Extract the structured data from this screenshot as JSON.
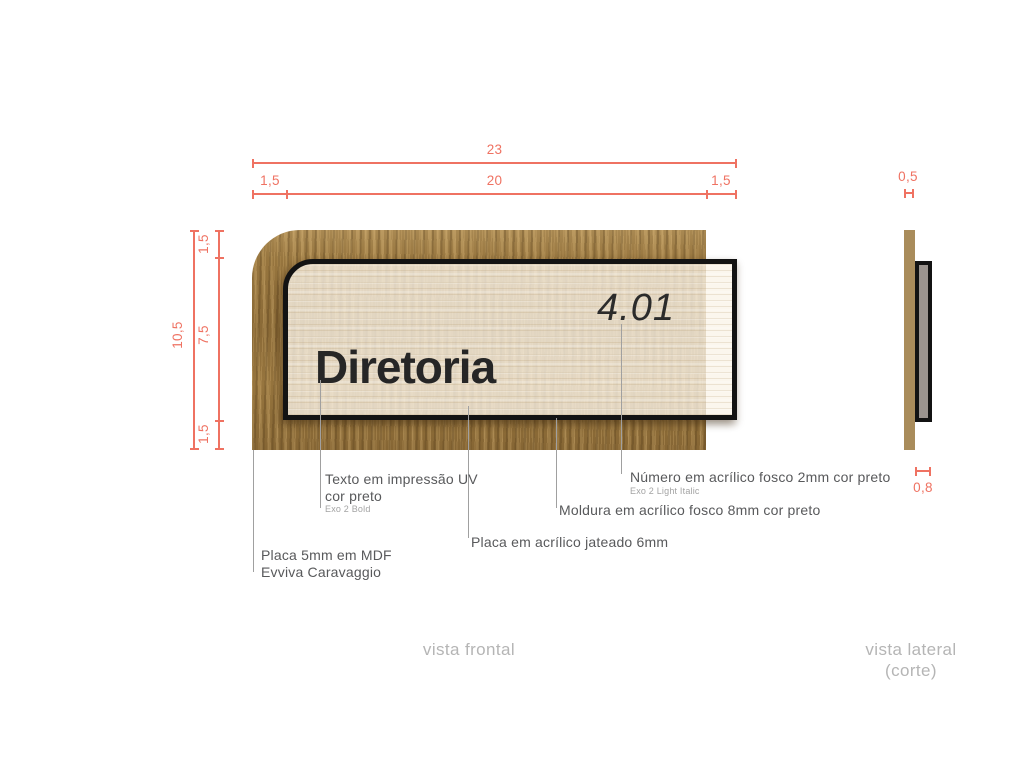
{
  "sign": {
    "room_name": "Diretoria",
    "room_number": "4.01"
  },
  "dimensions": {
    "top_total": "23",
    "top_left": "1,5",
    "top_center": "20",
    "top_right": "1,5",
    "left_total": "10,5",
    "left_top": "1,5",
    "left_middle": "7,5",
    "left_bottom": "1,5",
    "side_thickness_top": "0,5",
    "side_thickness_bottom": "0,8"
  },
  "callouts": {
    "uv_text": {
      "line1": "Texto em impressão UV",
      "line2": "cor preto",
      "sub": "Exo 2 Bold"
    },
    "mdf_plate": {
      "line1": "Placa 5mm em MDF",
      "line2": "Evviva Caravaggio"
    },
    "acrylic_plate": {
      "line1": "Placa em acrílico jateado 6mm"
    },
    "frame": {
      "line1": "Moldura em acrílico fosco 8mm cor preto"
    },
    "number": {
      "line1": "Número em acrílico fosco 2mm cor preto",
      "sub": "Exo 2 Light Italic"
    }
  },
  "views": {
    "front_label": "vista frontal",
    "side_label_line1": "vista lateral",
    "side_label_line2": "(corte)"
  },
  "colors": {
    "dimension": "#ef7262",
    "label_text": "#58595b",
    "sub_label_text": "#a3a3a3",
    "leader_line": "#a0a0a0",
    "footer_label": "#b5b5b5",
    "sign_text": "#262626",
    "wood_front": "#9f7d44",
    "wood_side": "#a98c5b",
    "frame_black": "#131313",
    "acrylic_side_gray": "#9b948f",
    "acrylic_fill": "#faf4e8"
  }
}
